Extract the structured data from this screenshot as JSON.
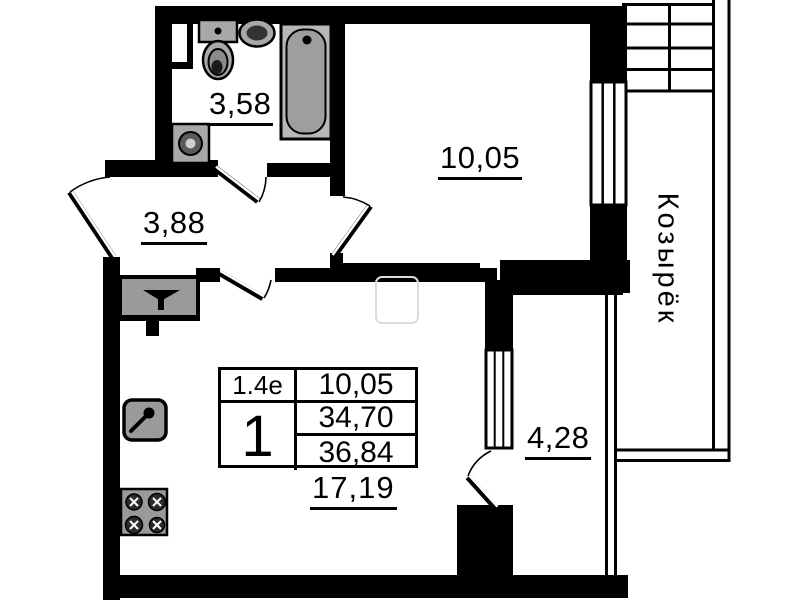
{
  "floor_plan": {
    "labels": {
      "bathroom_area": "3,58",
      "hallway_area": "3,88",
      "room_area": "10,05",
      "balcony_area": "4,28",
      "kitchen_living_area": "17,19",
      "canopy": "Козырёк"
    },
    "info_table": {
      "plan_type": "1.4е",
      "room_count": "1",
      "living_area": "10,05",
      "apartment_area": "34,70",
      "total_area": "36,84"
    },
    "colors": {
      "walls": "#000000",
      "fixtures": "#9a9a9a",
      "background": "#ffffff"
    }
  }
}
